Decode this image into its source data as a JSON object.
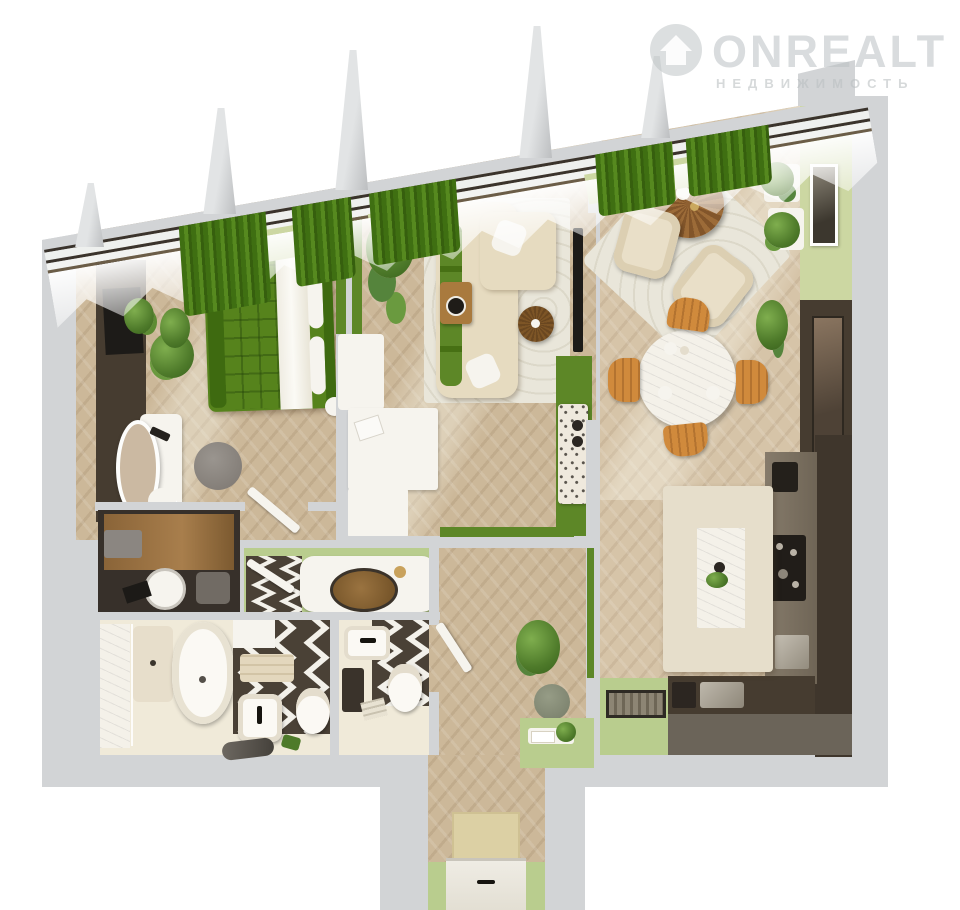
{
  "watermark": {
    "brand": "ONREALT",
    "subtitle": "НЕДВИЖИМОСТЬ",
    "logo_icon": "house-in-circle-icon"
  },
  "colors": {
    "page_bg": "#ffffff",
    "wall": "#d2d4d6",
    "wall_inner": "#dadcdd",
    "floor_wood": "#ccb899",
    "floor_wood_light": "#d6c4a8",
    "floor_bath": "#f0ead9",
    "green_curtain": "#477614",
    "green_wall": "#5d8727",
    "sage_wall": "#ccd7a2",
    "sage_floor": "#b9cd8e",
    "bed_green": "#56831c",
    "bed_green_dark": "#3e6a10",
    "sofa_beige": "#e6dbc0",
    "rug_light": "#e9e6da",
    "wood": "#a97a3e",
    "wood_dark": "#7d5526",
    "orange_chair": "#d08a3c",
    "dark_brown": "#463c30",
    "chevron_brown": "#4a4136",
    "laundry_dark": "#37302a",
    "counter_greige": "#867b6b",
    "island_cream": "#e6decb",
    "marble_white": "#f4f1e9",
    "dark_floor": "#6b6459",
    "white_fixture": "#f6f4ee",
    "mat_beige": "#dcd0a4",
    "tv_black": "#1d1b18",
    "frame_dark": "#3a332c",
    "watermark_gray": "#babfc2"
  },
  "rooms": [
    {
      "name": "bedroom"
    },
    {
      "name": "living-room"
    },
    {
      "name": "dining-lounge"
    },
    {
      "name": "kitchen"
    },
    {
      "name": "bathroom"
    },
    {
      "name": "toilet"
    },
    {
      "name": "laundry-closet"
    },
    {
      "name": "vanity-niche"
    },
    {
      "name": "hallway"
    },
    {
      "name": "entry-hall"
    }
  ],
  "furniture": [
    "double-bed",
    "wardrobe-tv-wall",
    "dressing-table-mirror",
    "pouf",
    "corner-sofa",
    "coffee-table",
    "side-table",
    "tv-panel",
    "console-sideboard",
    "lounge-armchairs",
    "round-lounge-table",
    "round-dining-table",
    "dining-chairs",
    "kitchen-island",
    "cooktop",
    "oven",
    "sink",
    "bathtub",
    "shower",
    "washbasin",
    "toilet-bowl",
    "washing-machine",
    "entry-door",
    "doormat",
    "plants",
    "green-curtains",
    "sheer-curtains"
  ]
}
